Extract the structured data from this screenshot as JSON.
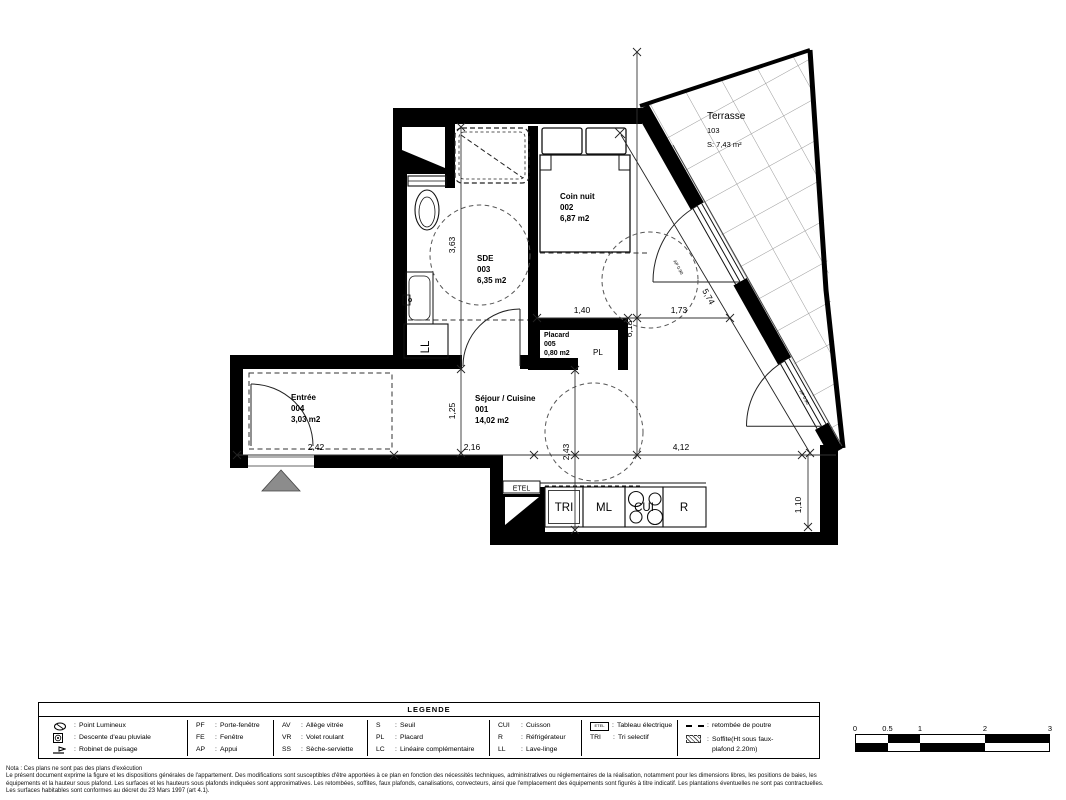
{
  "plan": {
    "rooms": {
      "terrasse": {
        "name": "Terrasse",
        "number": "103",
        "area": "S: 7,43 m²"
      },
      "coin_nuit": {
        "name": "Coin nuit",
        "number": "002",
        "area": "6,87 m2"
      },
      "sde": {
        "name": "SDE",
        "number": "003",
        "area": "6,35 m2"
      },
      "placard": {
        "name": "Placard",
        "number": "005",
        "area": "0,80 m2",
        "tag": "PL"
      },
      "entree": {
        "name": "Entrée",
        "number": "004",
        "area": "3,03 m2"
      },
      "sejour": {
        "name": "Séjour / Cuisine",
        "number": "001",
        "area": "14,02 m2"
      }
    },
    "equipment": {
      "ll": "LL",
      "etel": "ETEL",
      "tri": "TRI",
      "ml": "ML",
      "cui": "CUI",
      "r": "R"
    },
    "dims": {
      "d363": "3,63",
      "d140": "1,40",
      "d173": "1,73",
      "d618": "6,18",
      "d574": "5,74",
      "d125": "1,25",
      "d242": "2,42",
      "d216": "2,16",
      "d243": "2,43",
      "d412": "4,12",
      "d110": "1,10",
      "sill": "AP 0.90"
    }
  },
  "legend": {
    "title": "LEGENDE",
    "sep": ":",
    "symbols": [
      {
        "icon": "point-lumineux",
        "label": "Point Lumineux"
      },
      {
        "icon": "descente-eau-pluviale",
        "label": "Descente d'eau pluviale"
      },
      {
        "icon": "robinet-puisage",
        "label": "Robinet de puisage"
      }
    ],
    "abbr_cols": [
      [
        {
          "abbr": "PF",
          "label": "Porte-fenêtre"
        },
        {
          "abbr": "FE",
          "label": "Fenêtre"
        },
        {
          "abbr": "AP",
          "label": "Appui"
        }
      ],
      [
        {
          "abbr": "AV",
          "label": "Allège vitrée"
        },
        {
          "abbr": "VR",
          "label": "Volet roulant"
        },
        {
          "abbr": "SS",
          "label": "Sèche-serviette"
        }
      ],
      [
        {
          "abbr": "S",
          "label": "Seuil"
        },
        {
          "abbr": "PL",
          "label": "Placard"
        },
        {
          "abbr": "LC",
          "label": "Linéaire complémentaire"
        }
      ],
      [
        {
          "abbr": "CUI",
          "label": "Cuisson"
        },
        {
          "abbr": "R",
          "label": "Réfrigérateur"
        },
        {
          "abbr": "LL",
          "label": "Lave-linge"
        }
      ]
    ],
    "electrical": {
      "etel_icon": "ETEL",
      "etel_label": "Tableau électrique",
      "tri_abbr": "TRI",
      "tri_label": "Tri selectif"
    },
    "misc": {
      "beam_label": "retombée de poutre",
      "soffit_label_1": "Soffite(Ht sous faux-",
      "soffit_label_2": "plafond 2.20m)"
    }
  },
  "scalebar": {
    "labels": [
      "0",
      "0.5",
      "1",
      "2",
      "3"
    ]
  },
  "notes": {
    "line1": "Nota : Ces plans ne sont pas des plans d'exécution",
    "line2": "Le présent document exprime la figure et les dispositions générales de l'appartement. Des modifications sont susceptibles d'être apportées à ce plan en fonction des nécessités techniques, administratives ou réglementaires de la réalisation, notamment pour les dimensions libres, les positions de baies, les",
    "line3": "équipements et la hauteur sous plafond. Les surfaces et les hauteurs sous plafonds indiquées sont approximatives. Les retombées, soffites, faux plafonds, canalisations, convecteurs, ainsi que l'emplacement des équipements sont figurés à titre indicatif. Les plantations éventuelles ne sont pas contractuelles.",
    "line4": "Les surfaces habitables sont conformes au décret du 23 Mars 1997 (art 4.1)."
  }
}
